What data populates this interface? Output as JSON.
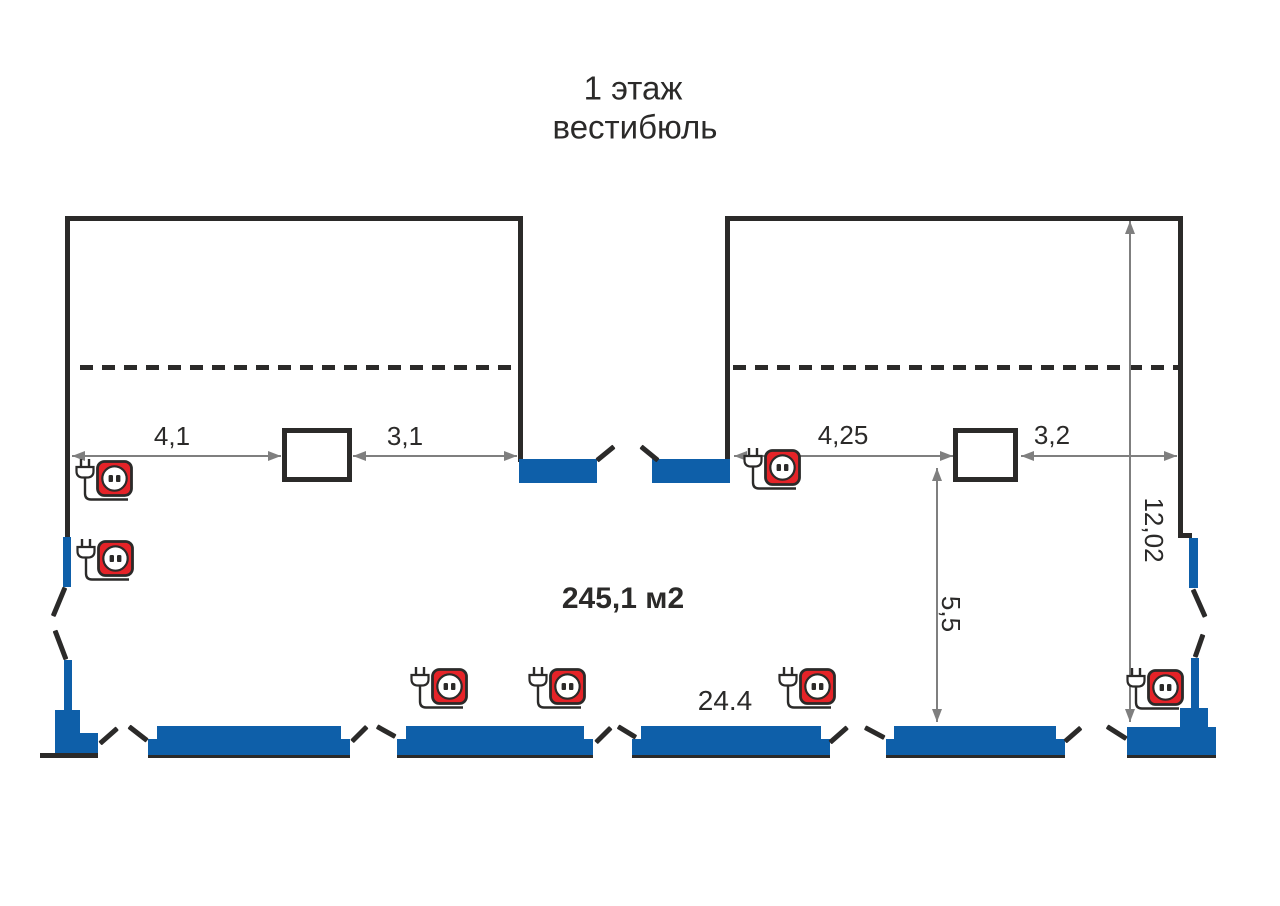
{
  "title": {
    "line1": "1 этаж",
    "line2": "вестибюль"
  },
  "labels": {
    "area": "245,1 м2",
    "dim_left_a": "4,1",
    "dim_left_b": "3,1",
    "dim_right_a": "4,25",
    "dim_right_b": "3,2",
    "dim_height": "12,02",
    "dim_depth": "5,5",
    "dim_bottom": "24.4"
  },
  "colors": {
    "wall": "#2b2a29",
    "glazing": "#0e5fa9",
    "outlet_red": "#e52328",
    "dimension_gray": "#7f7f7f",
    "text": "#2b2a29"
  },
  "outlets": [
    {
      "location": "left-room-wall",
      "x": 73,
      "y": 458
    },
    {
      "location": "left-wall",
      "x": 74,
      "y": 538
    },
    {
      "location": "right-room-wall",
      "x": 741,
      "y": 447
    },
    {
      "location": "bottom-storefront-1",
      "x": 408,
      "y": 666
    },
    {
      "location": "bottom-storefront-2",
      "x": 526,
      "y": 666
    },
    {
      "location": "bottom-storefront-3",
      "x": 776,
      "y": 666
    },
    {
      "location": "bottom-right-corner",
      "x": 1124,
      "y": 667
    }
  ]
}
